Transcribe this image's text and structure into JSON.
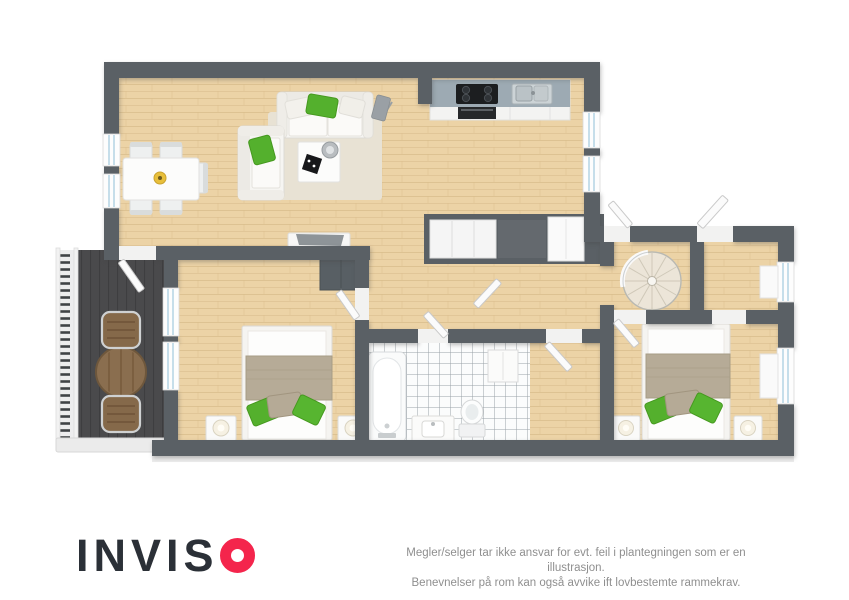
{
  "brand": {
    "name": "INVISO",
    "wordmark_letters": "INVIS"
  },
  "disclaimer": {
    "line1": "Megler/selger tar ikke ansvar for evt. feil i plantegningen som er en illustrasjon.",
    "line2": "Benevnelser på rom kan også avvike ift lovbestemte rammekrav."
  },
  "floorplan": {
    "type": "3d-top-down-apartment-plan",
    "rooms": [
      "living-room",
      "dining-area",
      "kitchen",
      "hallway",
      "entrance-closets",
      "stair-room",
      "entrance-hall",
      "bedroom-1",
      "bedroom-2",
      "bathroom",
      "walk-in-closet",
      "balcony"
    ],
    "furniture": [
      "sofa",
      "loveseat",
      "coffee-table",
      "rug",
      "tv-console",
      "floor-lamp",
      "dining-table",
      "dining-chairs",
      "fruit-bowl",
      "kitchen-counter",
      "cooktop",
      "oven",
      "kitchen-sink",
      "double-bed",
      "nightstand",
      "table-lamp",
      "wardrobe",
      "bathtub",
      "vanity-sink",
      "toilet",
      "bathroom-cabinet",
      "spiral-staircase",
      "balcony-table",
      "balcony-chairs",
      "balcony-railing"
    ]
  },
  "colors": {
    "bg": "#ffffff",
    "wall": "#5a6065",
    "wallDark": "#4c5256",
    "wood": "#ecd3a6",
    "woodLine": "#d9bc8b",
    "tile": "#fbfcfc",
    "tileLine": "#9aa2a7",
    "deck": "#4a4a4c",
    "deckLine": "#3e3e40",
    "green": "#54b02d",
    "greenDark": "#46991f",
    "rug": "#e8e2d4",
    "blanket": "#b6ab97",
    "counter": "#9daab3",
    "glass": "#b9d6e6",
    "white": "#fafafa",
    "logoDark": "#2b3037",
    "logoRed": "#f4254c",
    "disclaimer": "#8f8f8f"
  }
}
